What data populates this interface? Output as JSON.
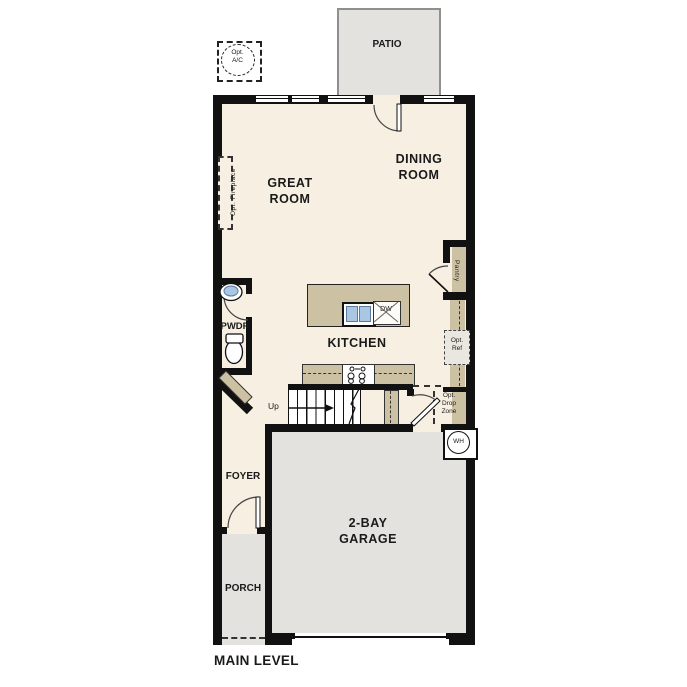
{
  "title": "MAIN LEVEL",
  "colors": {
    "floor": "#f7f0e2",
    "outdoor_concrete": "#e3e2df",
    "wall": "#111111",
    "cabinetry": "#cdc1a4",
    "sink_blue": "#a9c6e2"
  },
  "rooms": [
    {
      "name": "great-room",
      "label": "GREAT\nROOM"
    },
    {
      "name": "dining-room",
      "label": "DINING\nROOM"
    },
    {
      "name": "kitchen",
      "label": "KITCHEN"
    },
    {
      "name": "garage",
      "label": "2-BAY\nGARAGE"
    },
    {
      "name": "patio",
      "label": "PATIO"
    },
    {
      "name": "porch",
      "label": "PORCH"
    },
    {
      "name": "foyer",
      "label": "FOYER"
    },
    {
      "name": "powder-room",
      "label": "PWDR"
    },
    {
      "name": "pantry",
      "label": "Pantry"
    }
  ],
  "annotations": {
    "stairs_up": "Up",
    "dishwasher": "DW",
    "water_heater": "WH",
    "opt_ac": "Opt.\nA/C",
    "opt_ref": "Opt.\nRef",
    "opt_drop_zone": "Opt.\nDrop\nZone",
    "opt_fireplace": "Opt. Fireplace"
  }
}
